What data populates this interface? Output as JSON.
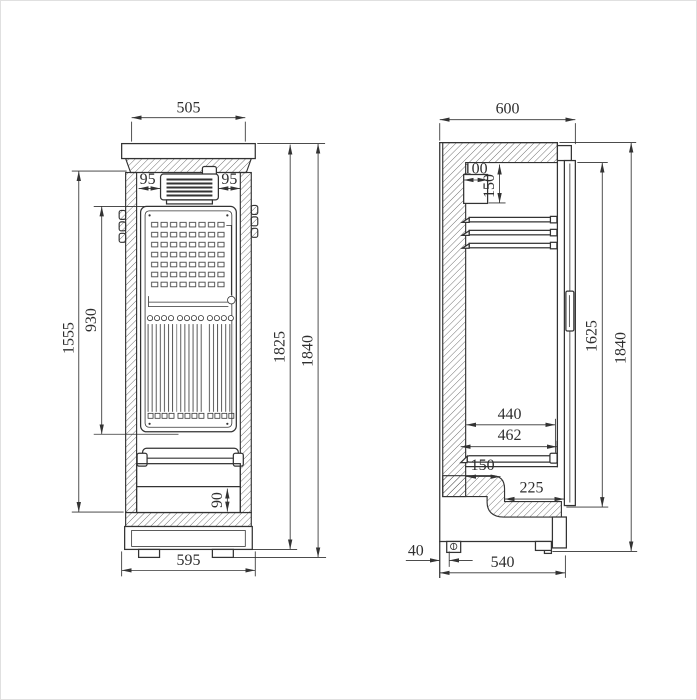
{
  "colors": {
    "background": "#ffffff",
    "line": "#333333",
    "frame": "#e0e0e0"
  },
  "views": {
    "front": {
      "name": "front-elevation",
      "dims": {
        "w505": "505",
        "v95l": "95",
        "v95r": "95",
        "h930": "930",
        "h1555": "1555",
        "h1825": "1825",
        "h1840": "1840",
        "h90": "90",
        "w595": "595"
      }
    },
    "side": {
      "name": "side-section",
      "dims": {
        "d600": "600",
        "d100": "100",
        "d150": "150",
        "d1625": "1625",
        "d1840": "1840",
        "d440": "440",
        "d462": "462",
        "d150b": "150",
        "d225": "225",
        "d40": "40",
        "d540": "540"
      }
    }
  }
}
